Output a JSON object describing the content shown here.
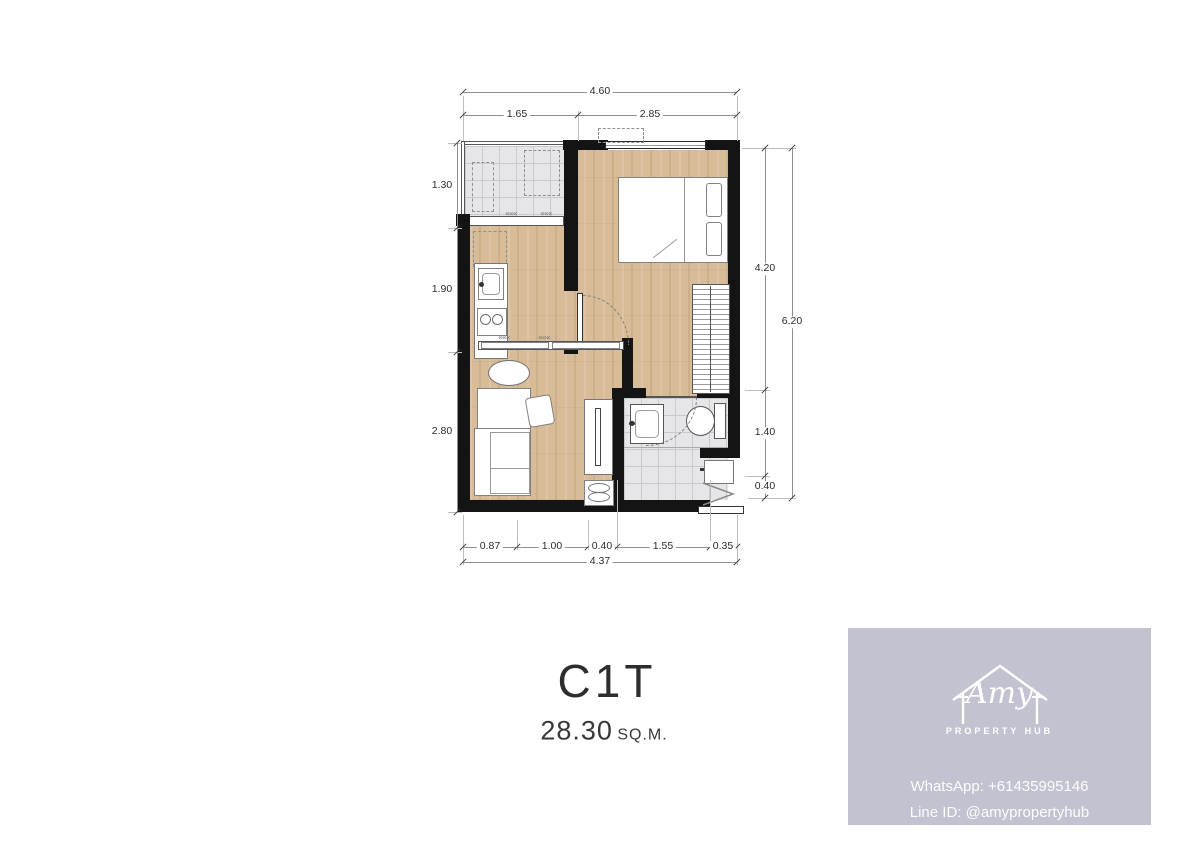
{
  "title": {
    "unit": "C1T",
    "area_value": "28.30",
    "area_unit": "SQ.M."
  },
  "dimensions": {
    "top": {
      "total": "4.60",
      "segments": [
        "1.65",
        "2.85"
      ]
    },
    "left": {
      "segments": [
        "1.30",
        "1.90",
        "2.80"
      ]
    },
    "right": {
      "segments": [
        "4.20",
        "1.40",
        "0.40"
      ],
      "total": "6.20"
    },
    "bottom": {
      "segments": [
        "0.87",
        "1.00",
        "0.40",
        "1.55",
        "0.35"
      ],
      "total": "4.37"
    }
  },
  "plan": {
    "slide_marks": "«««"
  },
  "brand": {
    "name": "Amy",
    "tagline": "PROPERTY HUB",
    "whatsapp": "WhatsApp: +61435995146",
    "line_id": "Line ID: @amypropertyhub",
    "icon": "house-outline-icon",
    "card_bg": "#c2c2d0"
  },
  "colors": {
    "wood": "#d8bc98",
    "tile": "#e6e6e9",
    "wall": "#141414"
  }
}
